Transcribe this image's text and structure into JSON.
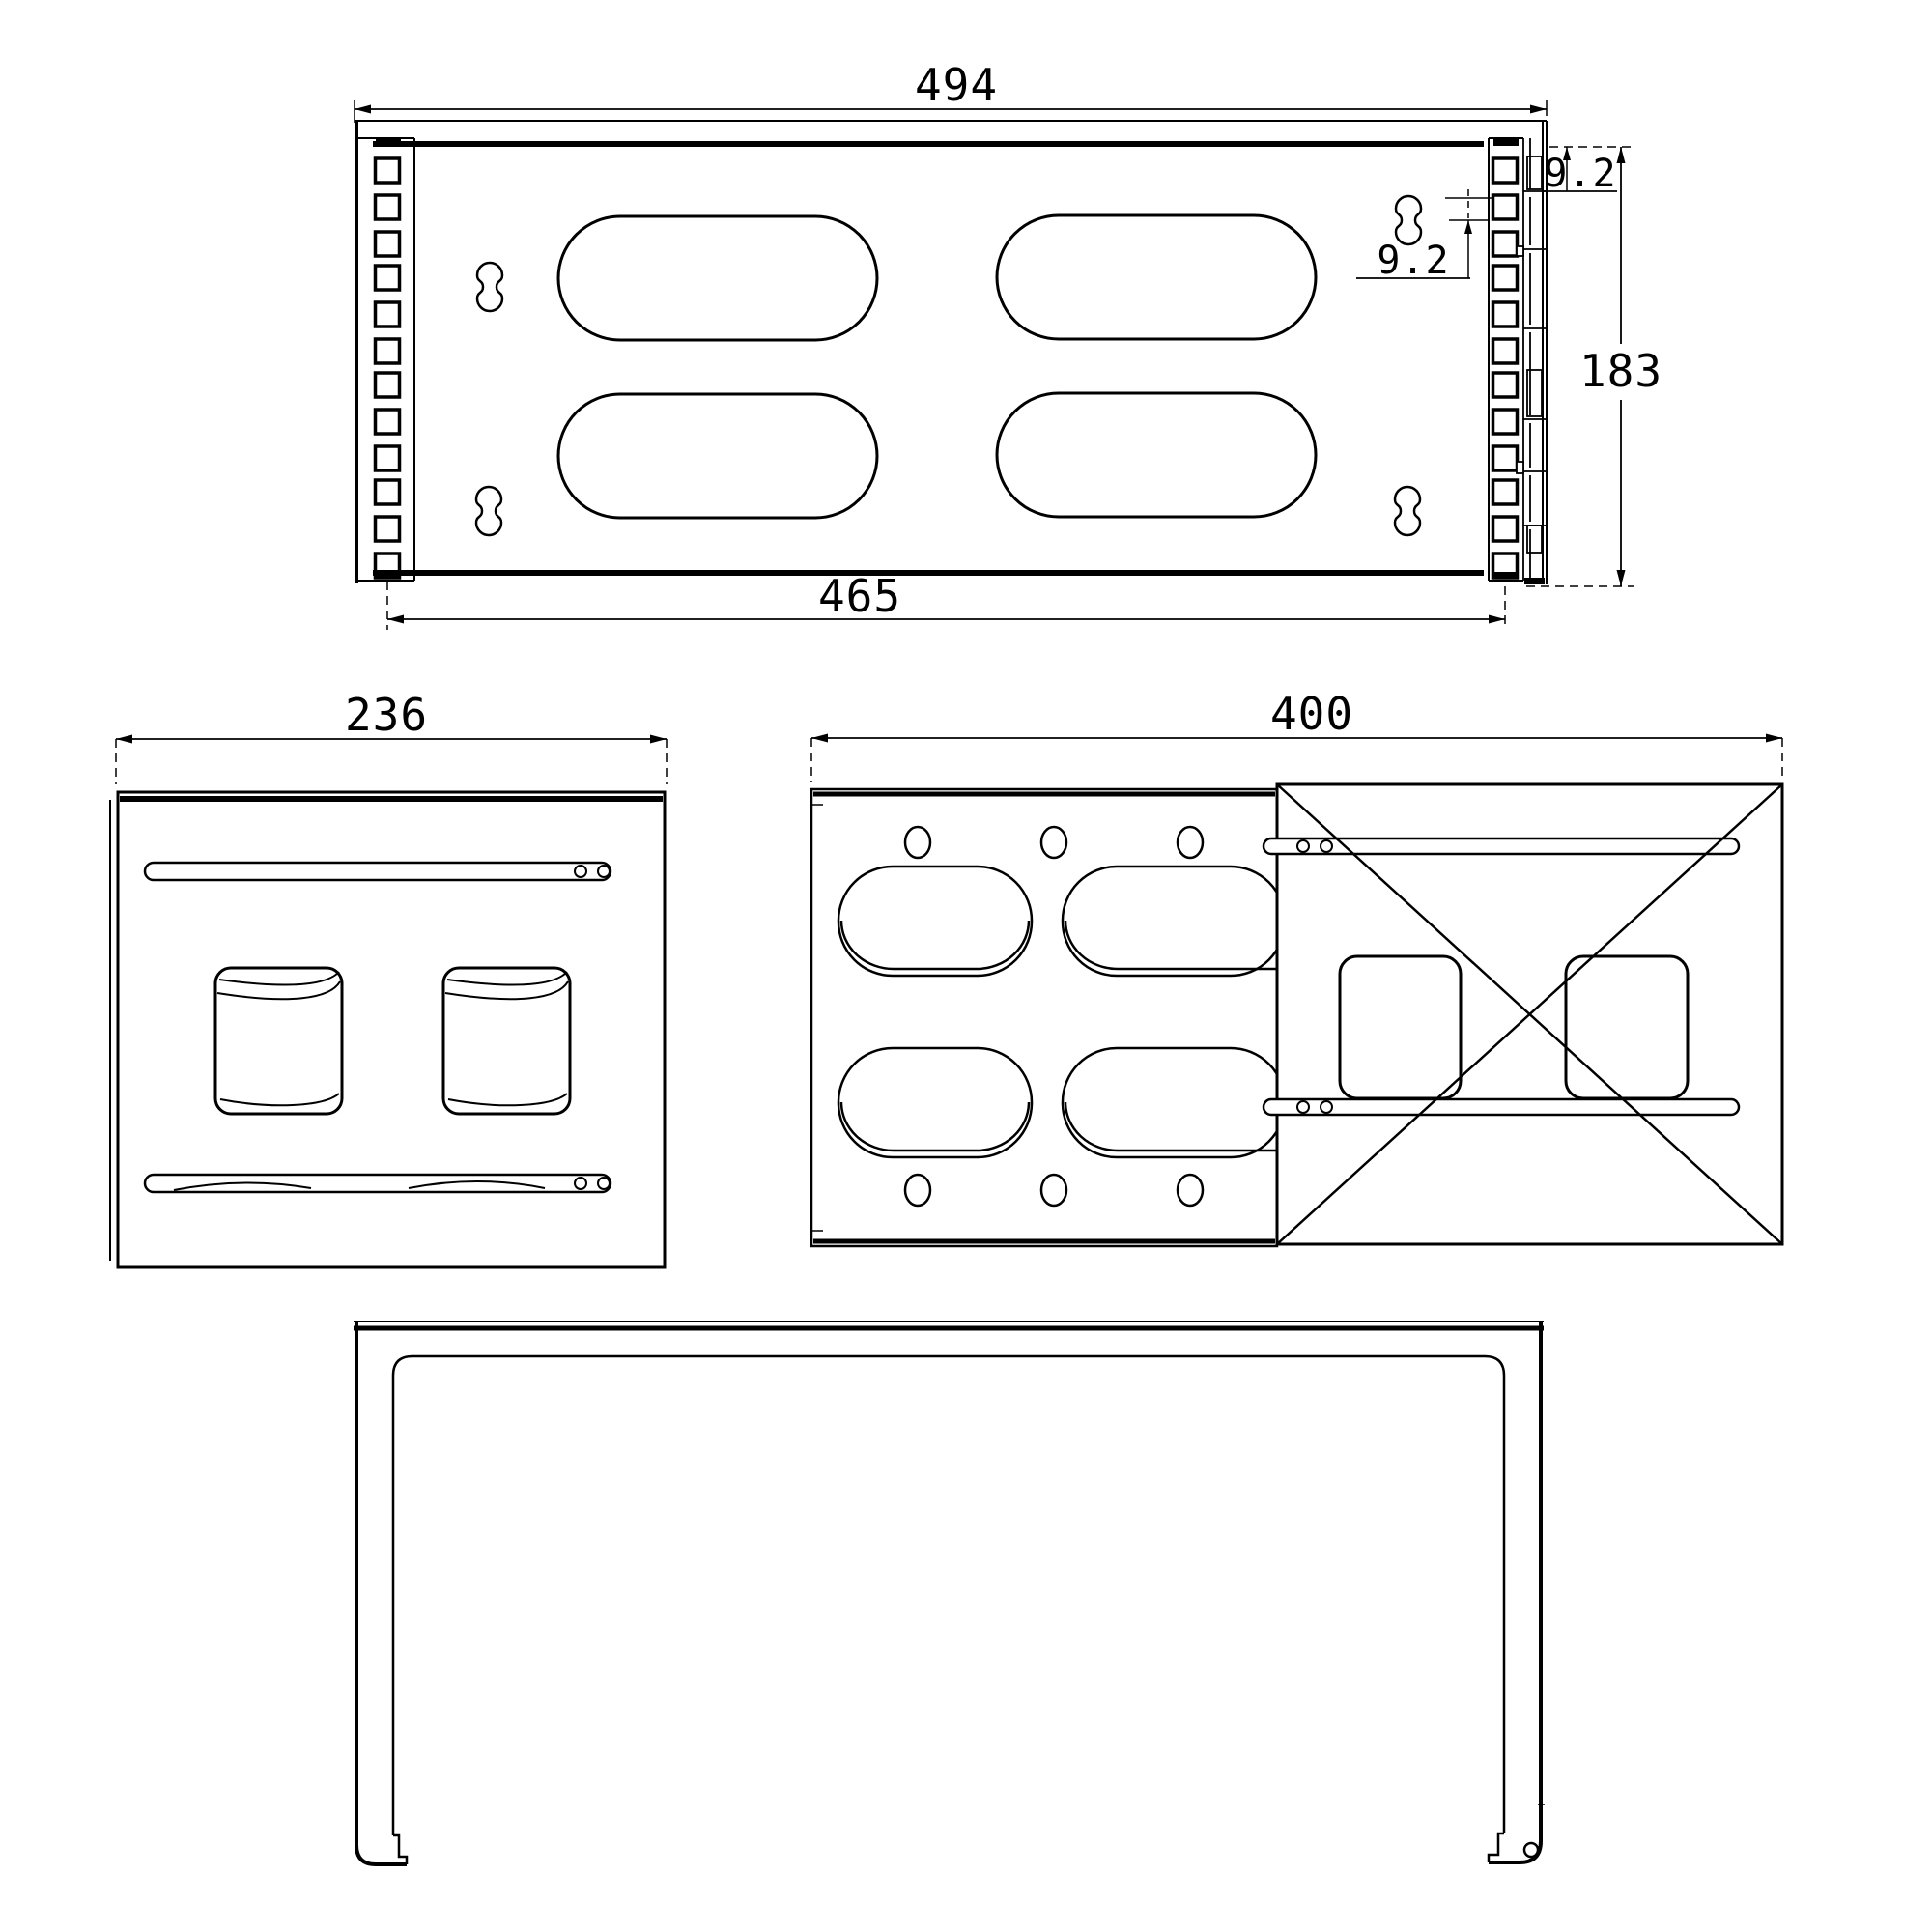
{
  "drawing": {
    "background": "#ffffff",
    "line_color": "#000000",
    "views": {
      "top_view": {
        "dims": {
          "overall_width": "494",
          "inner_width": "465",
          "overall_depth": "183",
          "flange_offset": "9.2",
          "slot_offset": "9.2"
        }
      },
      "side_view": {
        "dims": {
          "width": "236"
        }
      },
      "back_view": {
        "dims": {
          "width": "400"
        }
      },
      "front_view": {
        "dims": {}
      }
    }
  }
}
